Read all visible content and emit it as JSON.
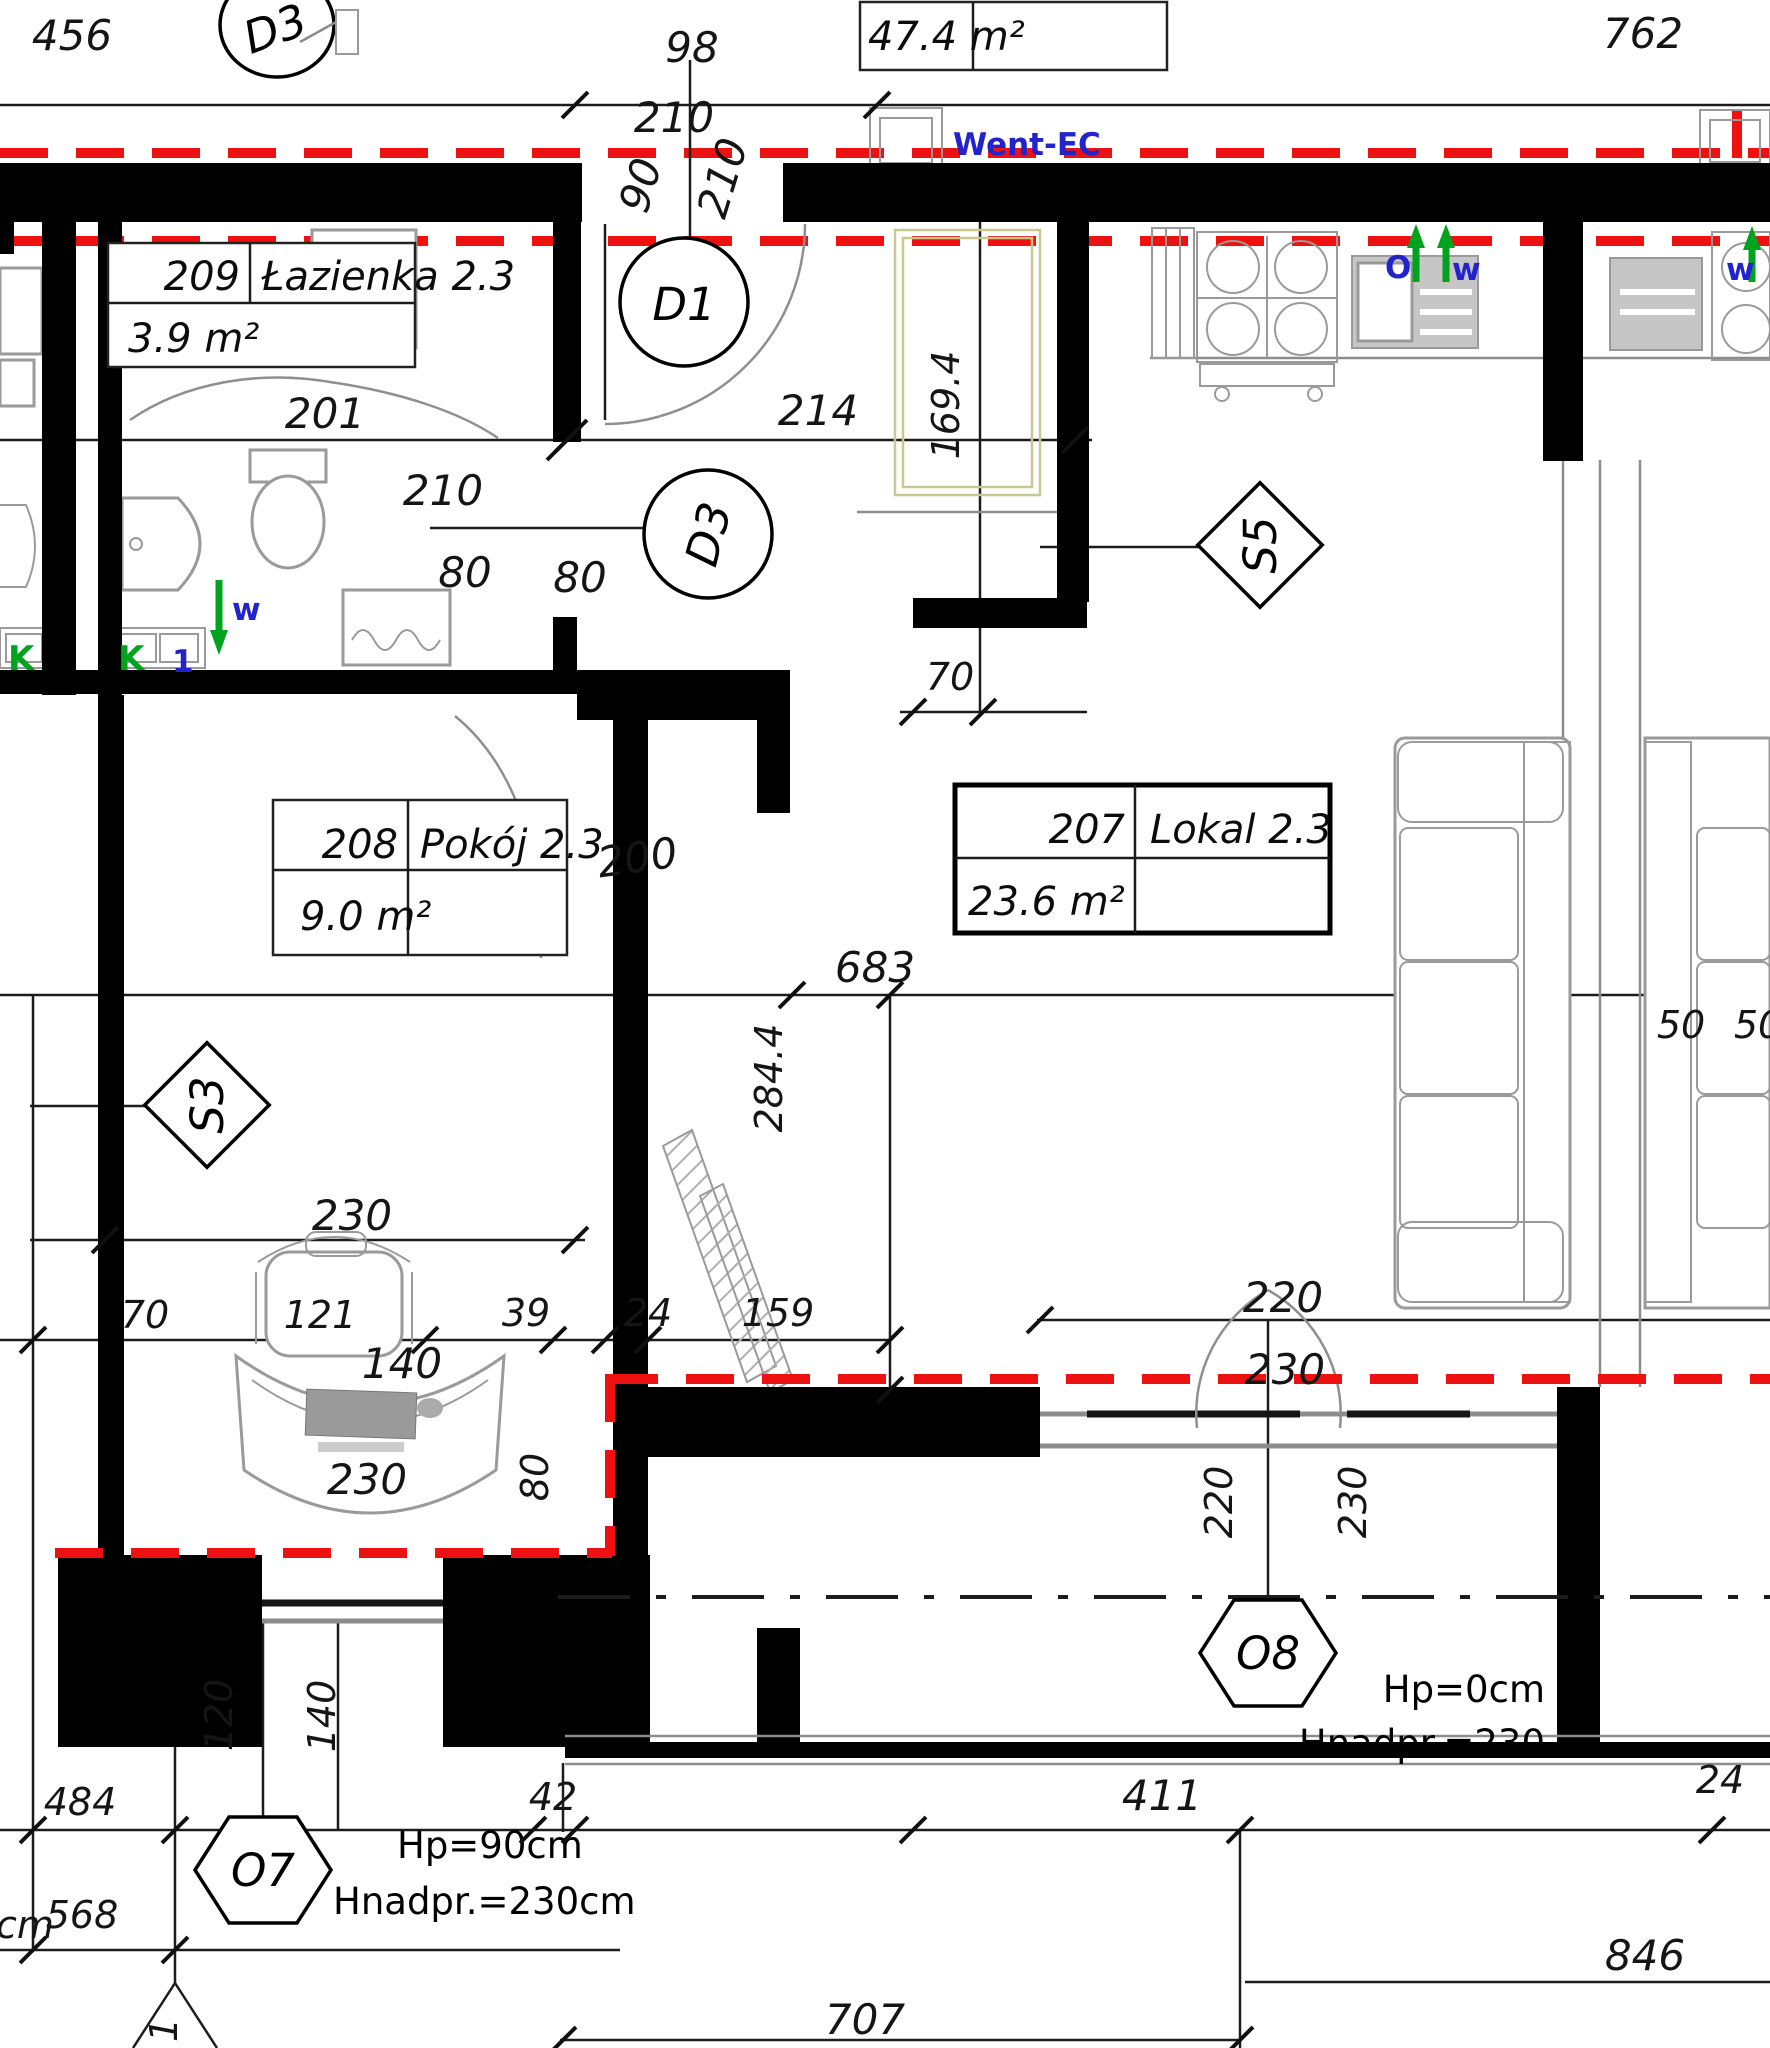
{
  "colors": {
    "wall": "#000000",
    "red_line": "#ee1111",
    "blue_text": "#2323cc",
    "green_mark": "#00a31e"
  },
  "area_total": {
    "value": "47.4 m²"
  },
  "rooms": [
    {
      "number": "209",
      "name": "Łazienka 2.3",
      "area": "3.9 m²"
    },
    {
      "number": "208",
      "name": "Pokój 2.3",
      "area": "9.0 m²"
    },
    {
      "number": "207",
      "name": "Lokal 2.3",
      "area": "23.6 m²"
    }
  ],
  "doors": {
    "d3_top": "D3",
    "d1": "D1",
    "d3_mid": "D3"
  },
  "windows": {
    "s3": "S3",
    "s5": "S5",
    "o7": "O7",
    "o8": "O8"
  },
  "labels": {
    "went": "Went-EC",
    "o": "O",
    "w_kitchen": "w",
    "w_bath": "w",
    "k_left": "K",
    "k_right": "K",
    "vent_one": "1",
    "hp_o8": "Hp=0cm",
    "hnadpr_o8": "Hnadpr.=230",
    "hp_o7": "Hp=90cm",
    "hnadpr_o7": "Hnadpr.=230cm",
    "cm_partial": "cm",
    "section_one": "1"
  },
  "dims": {
    "d456": "456",
    "d98": "98",
    "d762": "762",
    "d210_top": "210",
    "d90_door": "90",
    "d210_door": "210",
    "d201": "201",
    "d214": "214",
    "d169_4": "169.4",
    "d210_bath": "210",
    "d80_bath": "80",
    "d80_room": "80",
    "d200": "200",
    "d70_kitchen": "70",
    "d683": "683",
    "d284_4": "284.4",
    "d230_left": "230",
    "d70_left": "70",
    "d121": "121",
    "d39": "39",
    "d24_mid": "24",
    "d159": "159",
    "d140_desk": "140",
    "d230_desk": "230",
    "d80_desk": "80",
    "d220_win": "220",
    "d230_win": "230",
    "d220_v": "220",
    "d230_v": "230",
    "d50_a": "50",
    "d50_b": "50",
    "d120": "120",
    "d140_win": "140",
    "d484": "484",
    "d568": "568",
    "d42": "42",
    "d411": "411",
    "d24_right": "24",
    "d707": "707",
    "d846": "846"
  }
}
